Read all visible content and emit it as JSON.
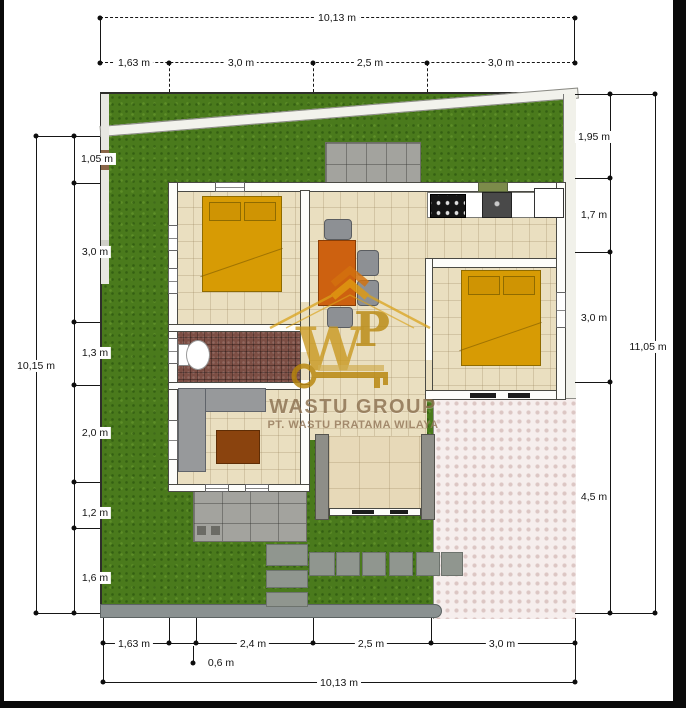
{
  "watermark": {
    "monogram": "WP",
    "brand": "WASTU GROUP",
    "company": "PT. WASTU PRATAMA WILAYA"
  },
  "dims": {
    "top_total": "10,13 m",
    "top_segments": [
      "1,63 m",
      "3,0 m",
      "2,5 m",
      "3,0 m"
    ],
    "left_total": "10,15 m",
    "left_segments": [
      "1,05 m",
      "3,0 m",
      "1,3 m",
      "2,0 m",
      "1,2 m",
      "1,6 m"
    ],
    "right_total": "11,05 m",
    "right_segments": [
      "1,95 m",
      "1,7 m",
      "3,0 m",
      "4,5 m"
    ],
    "bottom_total": "10,13 m",
    "bottom_segments": [
      "1,63 m",
      "2,4 m",
      "2,5 m",
      "3,0 m"
    ],
    "bottom_sub": "0,6 m"
  },
  "colors": {
    "grass": "#4a7a1c",
    "floor_tile": "#eadfc0",
    "bath_tile": "#7c4e44",
    "bed": "#d79b04",
    "dining_table": "#cd6110",
    "coffee_table": "#8a430e",
    "driveway": "#f6eeed",
    "watermark_gold": "#c9971c",
    "watermark_text": "#8c7150"
  }
}
